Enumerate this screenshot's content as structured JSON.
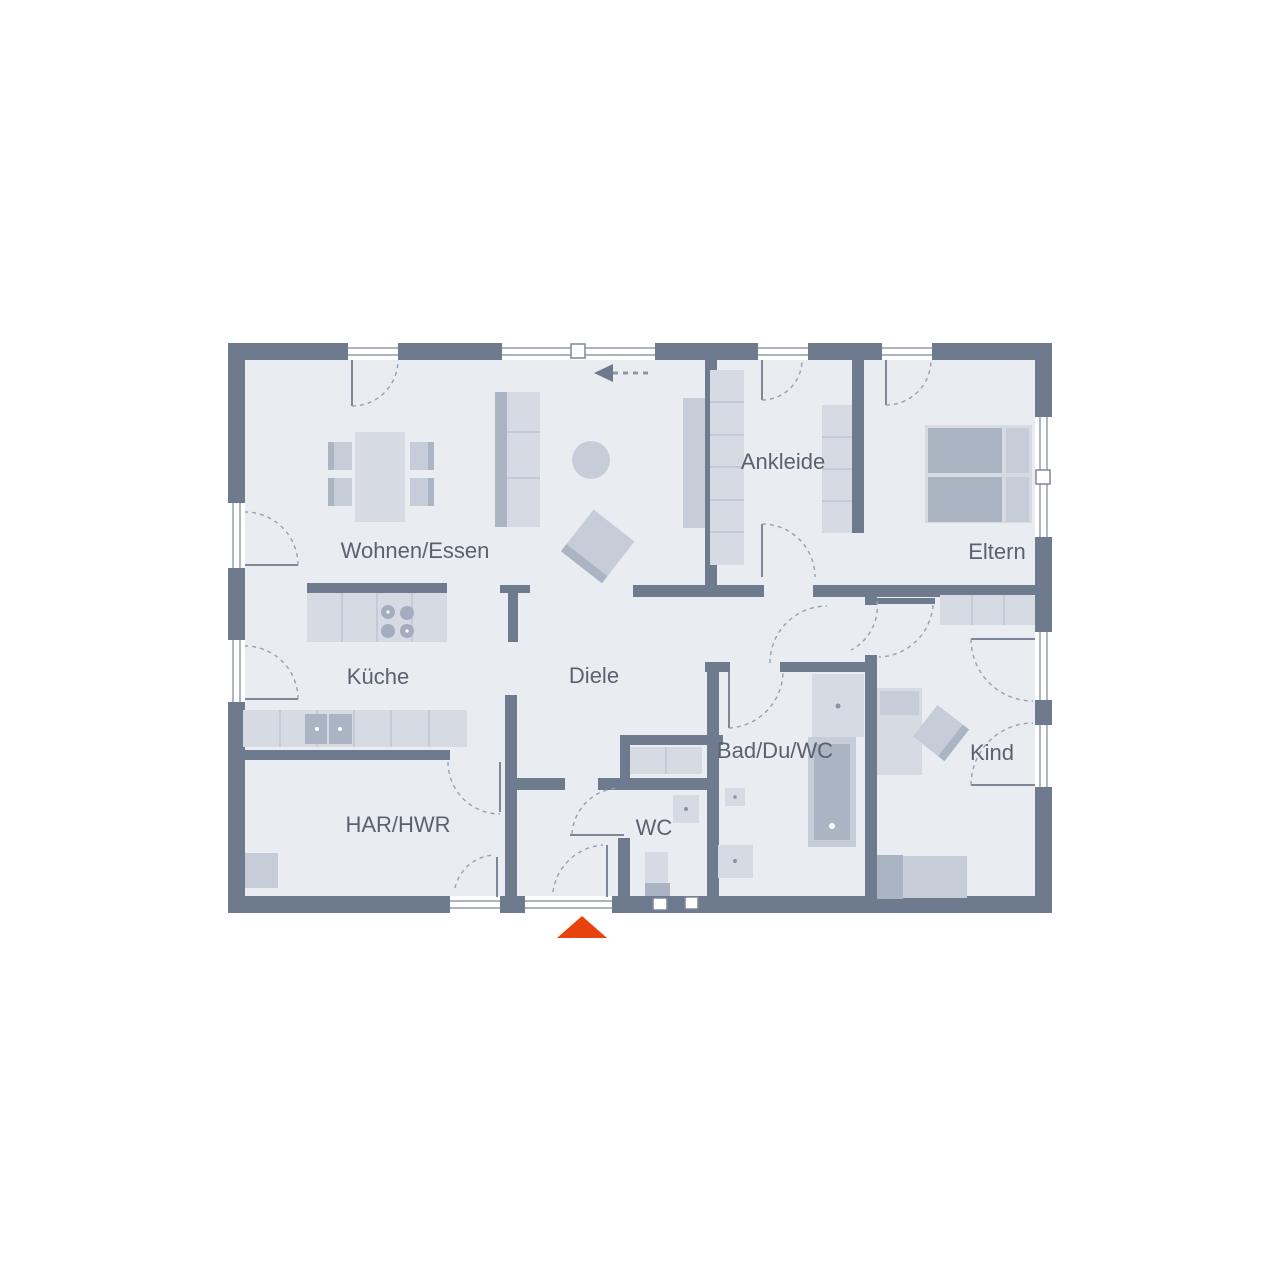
{
  "plan": {
    "type": "floor-plan",
    "rooms": [
      {
        "name": "wohnen-essen",
        "label": "Wohnen/Essen"
      },
      {
        "name": "kueche",
        "label": "Küche"
      },
      {
        "name": "diele",
        "label": "Diele"
      },
      {
        "name": "ankleide",
        "label": "Ankleide"
      },
      {
        "name": "eltern",
        "label": "Eltern"
      },
      {
        "name": "har-hwr",
        "label": "HAR/HWR"
      },
      {
        "name": "wc",
        "label": "WC"
      },
      {
        "name": "bad-du-wc",
        "label": "Bad/Du/WC"
      },
      {
        "name": "kind",
        "label": "Kind"
      }
    ],
    "colors": {
      "wall": "#6e7b8e",
      "floor": "#e9ecf1",
      "furniture_light": "#d5dae3",
      "furniture_mid": "#c6cdd9",
      "furniture_dark": "#aab4c2",
      "entrance_marker": "#e8430f",
      "label_text": "#5a6270"
    },
    "icons": [
      {
        "name": "entrance-triangle-icon",
        "meaning": "main entrance marker"
      },
      {
        "name": "sliding-arrow-icon",
        "meaning": "sliding element direction"
      }
    ]
  }
}
